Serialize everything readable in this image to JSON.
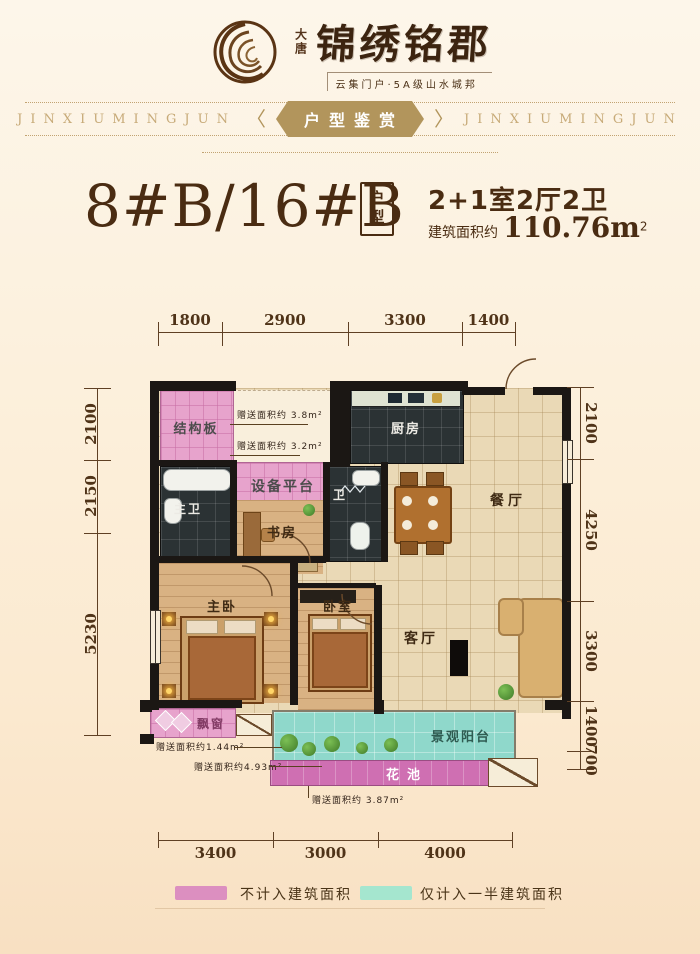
{
  "header": {
    "brand_seal": "大唐",
    "brand_name": "锦绣铭郡",
    "tagline": "云集门户·5A级山水城邦"
  },
  "banner": {
    "left_text": "JINXIUMINGJUN",
    "badge_label": "户型鉴赏",
    "right_text": "JINXIUMINGJUN",
    "left_chevron": "〈",
    "right_chevron": "〉",
    "badge_color": "#b2955c"
  },
  "title_block": {
    "unit_name": "8#B/16#B",
    "type_label": "户型",
    "layout_text": "2+1室2厅2卫",
    "area_prefix": "建筑面积约",
    "area_value": "110.76m",
    "area_sup": "2"
  },
  "floorplan": {
    "dims_top": [
      "1800",
      "2900",
      "3300",
      "1400"
    ],
    "dims_left": [
      "2100",
      "2150",
      "5230"
    ],
    "dims_right": [
      "2100",
      "4250",
      "3300",
      "1400",
      "700"
    ],
    "dims_bottom": [
      "3400",
      "3000",
      "4000"
    ],
    "rooms": [
      {
        "name": "structure-board",
        "label": "结构板"
      },
      {
        "name": "kitchen",
        "label": "厨房"
      },
      {
        "name": "equipment-platform",
        "label": "设备平台"
      },
      {
        "name": "master-bath",
        "label": "主卫"
      },
      {
        "name": "study",
        "label": "书房"
      },
      {
        "name": "bath",
        "label": "卫"
      },
      {
        "name": "dining-room",
        "label": "餐厅"
      },
      {
        "name": "master-bedroom",
        "label": "主卧"
      },
      {
        "name": "bedroom",
        "label": "卧室"
      },
      {
        "name": "living-room",
        "label": "客厅"
      },
      {
        "name": "bay-window",
        "label": "飘窗"
      },
      {
        "name": "view-balcony",
        "label": "景观阳台"
      },
      {
        "name": "flower-bed",
        "label": "花池"
      }
    ],
    "annotations": [
      {
        "label": "赠送面积约 3.8m²"
      },
      {
        "label": "赠送面积约 3.2m²"
      },
      {
        "label": "赠送面积约1.44m²"
      },
      {
        "label": "赠送面积约4.93m²"
      },
      {
        "label": "赠送面积约 3.87m²"
      }
    ]
  },
  "legend": {
    "items": [
      {
        "label": "不计入建筑面积",
        "color": "#dc8fc0"
      },
      {
        "label": "仅计入一半建筑面积",
        "color": "#a5e6cf"
      }
    ]
  },
  "colors": {
    "background_cream": "#fdf3e2",
    "brand_brown": "#3c2410",
    "accent_gold": "#b2955c",
    "gift_pink": "#e7a3cc",
    "half_area_teal": "#8fd8cb",
    "flower_magenta": "#cf6fb2",
    "wall_black": "#1b1714"
  }
}
